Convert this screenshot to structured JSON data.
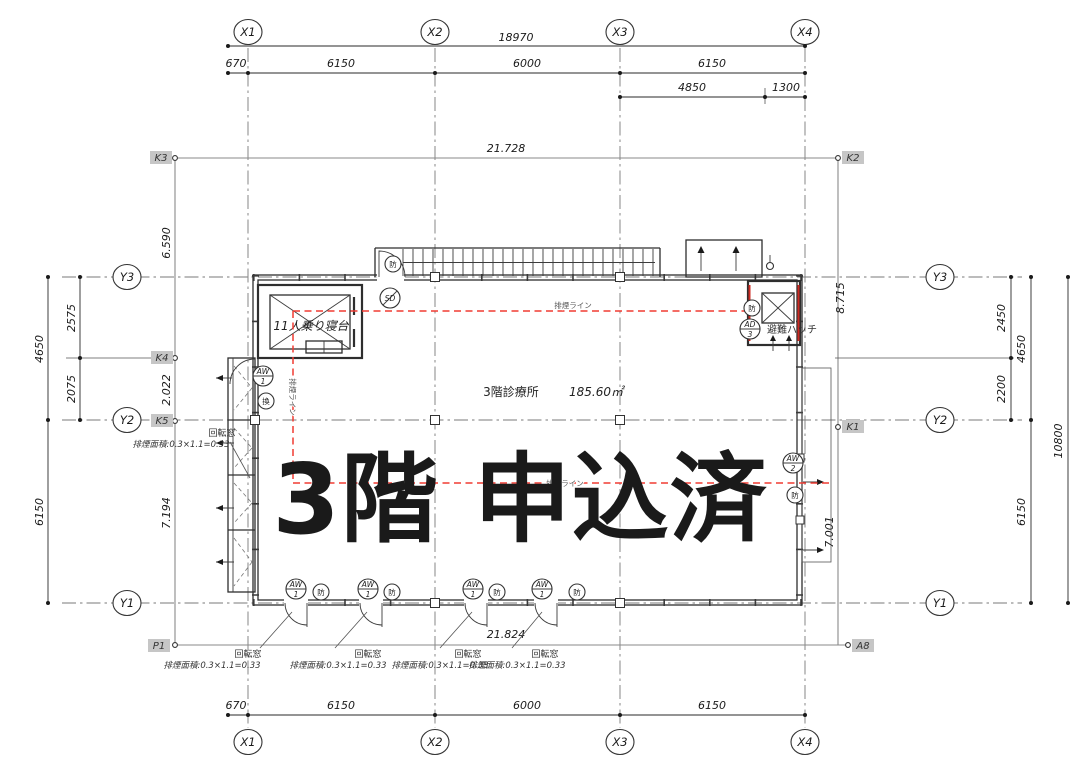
{
  "overlay": {
    "text": "3階 申込済",
    "color": "#e8231c"
  },
  "room": {
    "label": "3階診療所",
    "area": "185.60㎡"
  },
  "labels": {
    "elevator": "11人乗り寝台",
    "hatch": "避難ハッチ",
    "smoke_line": "排煙ライン",
    "window": "回転窓",
    "window_formula": "排煙面積:0.3×1.1=0.33"
  },
  "symbols": {
    "sd": "SD",
    "fire": "防",
    "vent": "換",
    "aw": "AW",
    "ad": "AD",
    "n1": "1",
    "n2": "2",
    "n3": "3"
  },
  "grid": {
    "x": [
      "X1",
      "X2",
      "X3",
      "X4"
    ],
    "y": [
      "Y3",
      "Y2",
      "Y1"
    ],
    "markers": {
      "k3": "K3",
      "k2": "K2",
      "k4": "K4",
      "k5": "K5",
      "k1": "K1",
      "p1": "P1",
      "a8": "A8"
    }
  },
  "dims": {
    "top_total": "18970",
    "top_segs": [
      "670",
      "6150",
      "6000",
      "6150"
    ],
    "top_sub": [
      "4850",
      "1300"
    ],
    "k_top": "21.728",
    "bottom_total": "21.824",
    "bottom_segs": [
      "670",
      "6150",
      "6000",
      "6150"
    ],
    "left": {
      "outer": "4650",
      "upper": "2575",
      "lower": "2075",
      "span": "6150",
      "k1": "6.590",
      "k2": "2.022",
      "k3": "7.194"
    },
    "right": {
      "upper": "2450",
      "lower": "2200",
      "mid": "4650",
      "span": "6150",
      "total": "10800",
      "k1": "8.715",
      "k2": "7.001"
    }
  }
}
